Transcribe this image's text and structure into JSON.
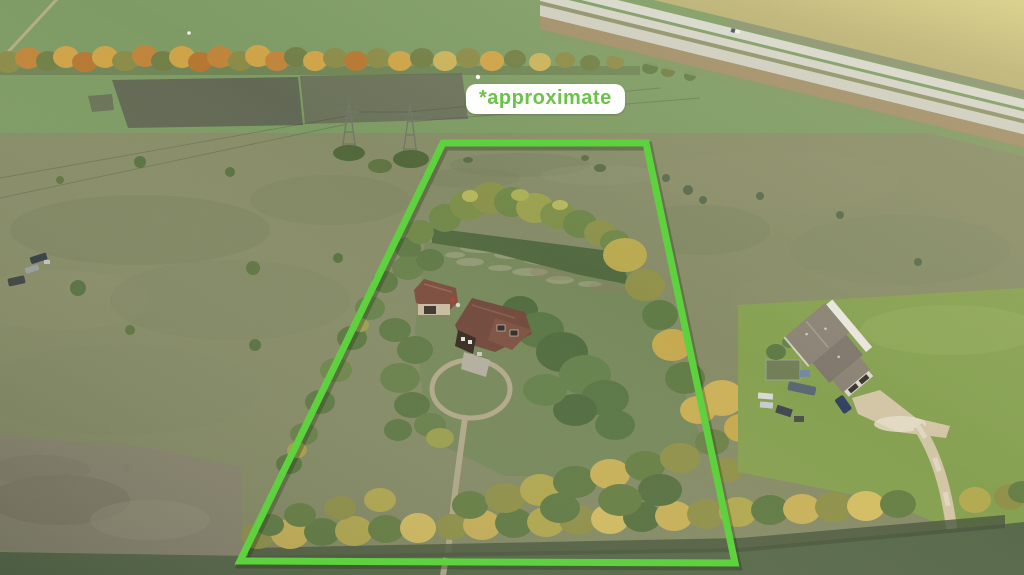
{
  "overlay": {
    "label": "*approximate",
    "label_text_color": "#6cc24a",
    "label_bg_color": "#fefefc",
    "boundary_color": "#5ed13f",
    "boundary_points": "443,143 646,143 735,563 240,561",
    "boundary_stroke_width": 7
  },
  "scene": {
    "alt": "Aerial drone view of a rural acreage outlined in green: tree-ringed parcel with a house, detached garage and loop driveway, autumn shelterbelt tree rows, neighboring two-storey house at right, divided highway at top right, open farm fields all around",
    "palette": {
      "field_green": "#7c9a62",
      "pasture_olive": "#868b66",
      "scrub_gray": "#8a8371",
      "meadow_green": "#75885a",
      "lawn_green": "#85a04f",
      "dark_field": "#566749",
      "highway_white": "#d8d8cf",
      "shoulder_brown": "#a08d67",
      "road_tan": "#b3a98c",
      "autumn_orange": "#c08338",
      "autumn_gold": "#cbb252",
      "tree_green": "#5d7844",
      "tree_dark": "#4e6a3d",
      "roof_brown": "#6f4639",
      "neighbor_roof": "#8a8274",
      "beyond_tan": "#b3a96e"
    }
  }
}
